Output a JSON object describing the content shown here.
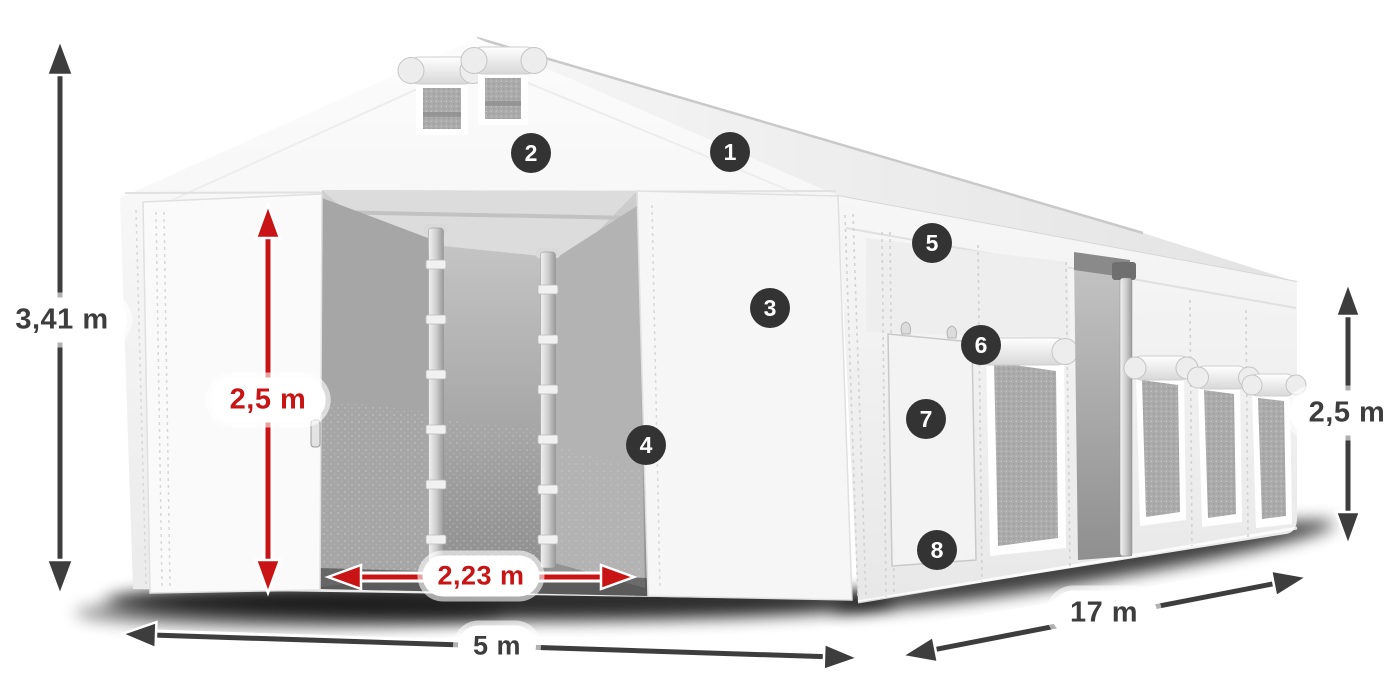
{
  "dimensions": {
    "total_height": "3,41 m",
    "entrance_height": "2,5 m",
    "entrance_width": "2,23 m",
    "width": "5 m",
    "length": "17 m",
    "side_height": "2,5 m"
  },
  "markers": [
    {
      "label": "1"
    },
    {
      "label": "2"
    },
    {
      "label": "3"
    },
    {
      "label": "4"
    },
    {
      "label": "5"
    },
    {
      "label": "6"
    },
    {
      "label": "7"
    },
    {
      "label": "8"
    }
  ],
  "colors": {
    "dimension_red": "#c81414",
    "dimension_dark": "#3d3d3d",
    "marker_background": "#333333",
    "label_background": "#ffffff",
    "tent_white": "#f5f5f5"
  }
}
